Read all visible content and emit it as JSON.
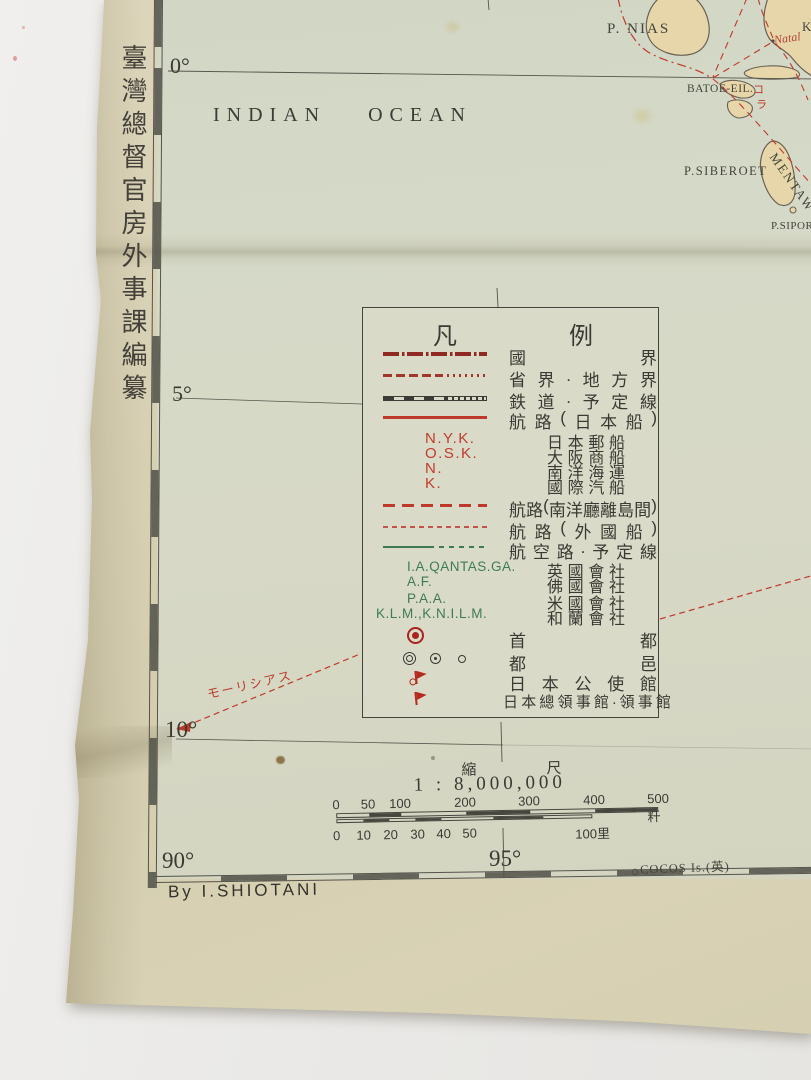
{
  "margin": {
    "vertical_title": "臺灣總督官房外事課編纂",
    "byline": "By I.SHIOTANI"
  },
  "map": {
    "ocean": {
      "word1": "INDIAN",
      "word2": "OCEAN"
    },
    "graticule": {
      "lat_0": "0°",
      "lat_5": "5°",
      "lat_10": "10°",
      "lon_90": "90°",
      "lon_95": "95°"
    },
    "labels": {
      "nias": "P. NIAS",
      "natal": "Natal",
      "batoe": "BATOE-EIL.",
      "siberoet": "P.SIBEROET",
      "mentawei": "MENTAW",
      "sipora": "P.SIPOR",
      "cocos": "COCOS Is.(英)",
      "mauritius": "モーリシアス",
      "edge_cut": "K",
      "route_char_1": "コ",
      "route_char_2": "ラ"
    }
  },
  "legend": {
    "title": [
      "凡",
      "例"
    ],
    "rows": [
      {
        "type": "line-national-boundary",
        "label": "國界"
      },
      {
        "type": "line-province-boundary",
        "label": "省界.地方界"
      },
      {
        "type": "line-railway",
        "label": "鉄道.予定線"
      },
      {
        "type": "line-route-japanese",
        "label": "航路(日本船)"
      },
      {
        "type": "abbr-red",
        "abbr": "N.Y.K.",
        "label": "日本郵船"
      },
      {
        "type": "abbr-red",
        "abbr": "O.S.K.",
        "label": "大阪商船"
      },
      {
        "type": "abbr-red",
        "abbr": "N.",
        "label": "南洋海運"
      },
      {
        "type": "abbr-red",
        "abbr": "K.",
        "label": "國際汽船"
      },
      {
        "type": "line-route-nanyo",
        "label": "航路(南洋廳離島間)"
      },
      {
        "type": "line-route-foreign",
        "label": "航路(外國船)"
      },
      {
        "type": "line-air-route",
        "label": "航空路.予定線"
      },
      {
        "type": "abbr-green",
        "abbr": "I.A.QANTAS.GA.",
        "label": "英國會社"
      },
      {
        "type": "abbr-green",
        "abbr": "A.F.",
        "label": "佛國會社"
      },
      {
        "type": "abbr-green",
        "abbr": "P.A.A.",
        "label": "米國會社"
      },
      {
        "type": "abbr-green",
        "abbr": "K.L.M.,K.N.I.L.M.",
        "label": "和蘭會社"
      },
      {
        "type": "symbol-capital",
        "label": "首都"
      },
      {
        "type": "symbol-towns",
        "label": "都邑"
      },
      {
        "type": "symbol-legation-flag",
        "label": "日本公使館"
      },
      {
        "type": "symbol-consulate-flag",
        "label": "日本總領事館.領事館"
      }
    ]
  },
  "scale": {
    "caption": [
      "縮",
      "尺"
    ],
    "ratio": "1 : 8,000,000",
    "km_ticks": [
      "0",
      "50",
      "100",
      "200",
      "300",
      "400",
      "500粁"
    ],
    "ri_ticks": [
      "0",
      "10",
      "20",
      "30",
      "40",
      "50",
      "100里"
    ]
  },
  "colors": {
    "route_red": "#bf392b",
    "boundary_dark_red": "#8e2a22",
    "air_route_green": "#3f7b52",
    "ink": "#3b3a33",
    "land": "#e6d6a9",
    "sea": "#d5d9c7",
    "paper": "#d8d1b5"
  }
}
